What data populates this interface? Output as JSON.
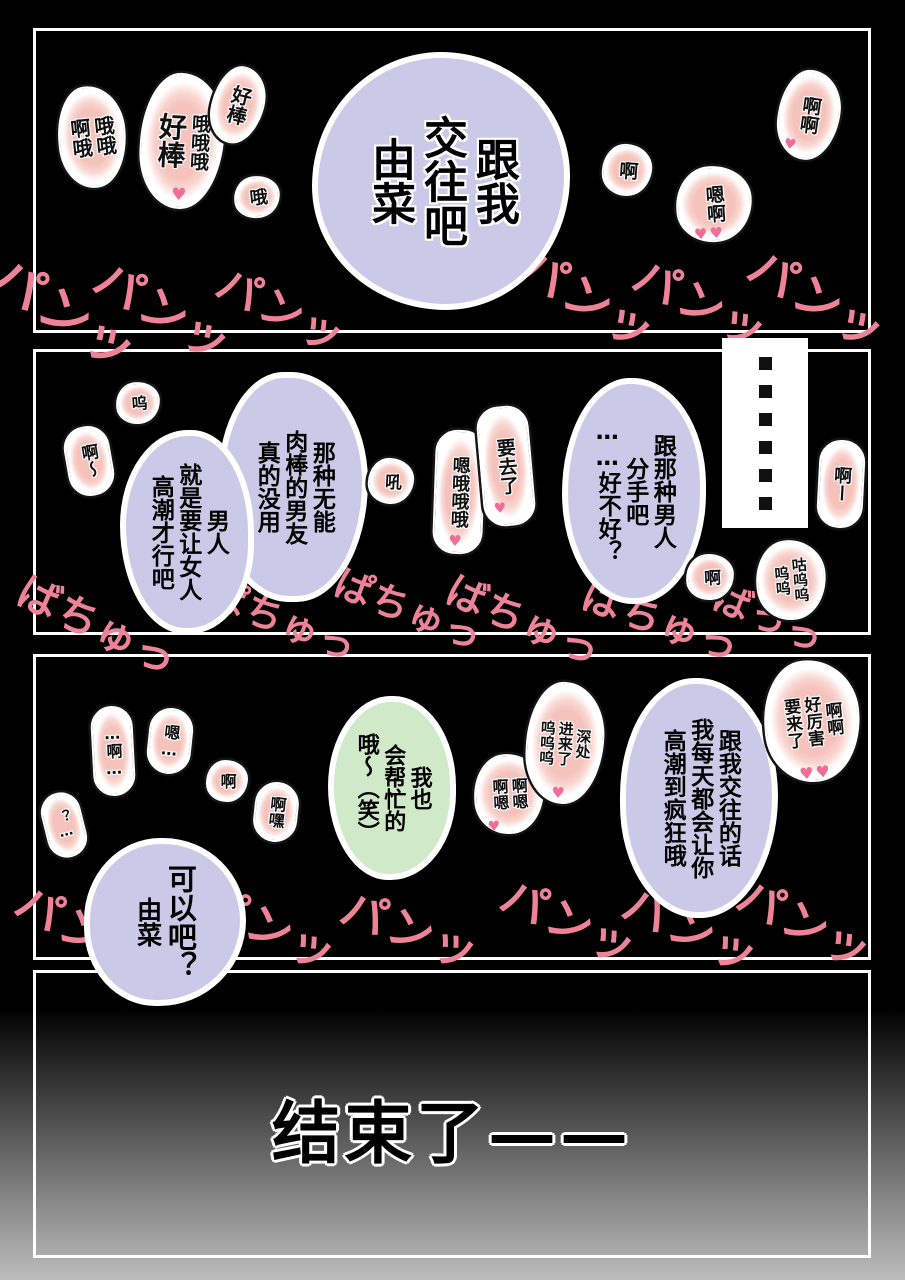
{
  "colors": {
    "background": "#000000",
    "panel_border": "#ffffff",
    "bubble_lavender": "#cacae8",
    "bubble_green": "#cfe9c9",
    "burst_pink": "#f5c2bc",
    "sfx_pink": "#ee8397",
    "heart_pink": "#ef6d96"
  },
  "page": {
    "end_text": "结束了——"
  },
  "p1": {
    "bubble": [
      "跟我",
      "交往吧",
      "由菜"
    ],
    "bursts": {
      "ohh": {
        "cols": [
          "哦哦",
          "啊哦"
        ]
      },
      "haobang_ohh": {
        "cols": [
          "哦哦哦",
          "好棒"
        ],
        "heart": "♥"
      },
      "haobang": {
        "cols": [
          "好棒"
        ]
      },
      "oh": {
        "cols": [
          "哦"
        ]
      },
      "a": {
        "cols": [
          "啊"
        ]
      },
      "aa": {
        "cols": [
          "啊啊"
        ],
        "heart": "♥"
      },
      "en_a": {
        "cols": [
          "嗯啊"
        ],
        "heart": "♥♥"
      }
    },
    "sfx": [
      "パンッ",
      "パンッ",
      "パンッ",
      "パンッ",
      "パンッ",
      "パンッ"
    ]
  },
  "p2": {
    "bubble_left_a": [
      "那种无能",
      "肉棒的男友",
      "真的没用"
    ],
    "bubble_left_b": [
      "男人",
      "就是要让女人",
      "高潮才行吧"
    ],
    "bubble_right": [
      "跟那种男人",
      "分手吧",
      "……好不好？"
    ],
    "pause": "……",
    "bursts": {
      "wu": {
        "cols": [
          "呜"
        ]
      },
      "a_wave": {
        "cols": [
          "啊～"
        ]
      },
      "hou": {
        "cols": [
          "吼"
        ]
      },
      "en_ooo": {
        "cols": [
          "嗯哦哦哦"
        ],
        "heart": "♥"
      },
      "yao_qu_le": {
        "cols": [
          "要去了"
        ],
        "heart": "♥"
      },
      "a_long": {
        "cols": [
          "啊ー"
        ]
      },
      "a": {
        "cols": [
          "啊"
        ]
      },
      "gu_wu": {
        "cols": [
          "咕呜呜",
          "呜呜"
        ]
      }
    },
    "sfx": [
      "ばちゅっ",
      "ぱちゅっ",
      "ぱちゅっ",
      "ばちゅっ",
      "ばちゅっ",
      "ばっっ"
    ]
  },
  "p3": {
    "bubble_right": [
      "跟我交往的话",
      "我每天都会让你",
      "高潮到疯狂哦"
    ],
    "bubble_green": [
      "我也",
      "会帮忙的",
      "哦～（笑）"
    ],
    "bubble_ok": [
      "可以吧？",
      "由菜"
    ],
    "bursts": {
      "q": {
        "cols": [
          "？…"
        ]
      },
      "a_dots": {
        "cols": [
          "…啊…"
        ]
      },
      "en_dots": {
        "cols": [
          "嗯…"
        ]
      },
      "a": {
        "cols": [
          "啊"
        ]
      },
      "a_hei": {
        "cols": [
          "啊嘿"
        ]
      },
      "a_en": {
        "cols": [
          "啊嗯",
          "啊嗯"
        ],
        "heart": "♥"
      },
      "deep": {
        "cols": [
          "深处",
          "进来了",
          "呜呜呜"
        ],
        "heart": "♥"
      },
      "amazing": {
        "cols": [
          "啊啊",
          "好厉害",
          "要来了"
        ],
        "heart": "♥♥"
      }
    },
    "sfx": [
      "パンッ",
      "パンッ",
      "パンッ",
      "パンッ",
      "パンッ",
      "パンッ"
    ]
  }
}
